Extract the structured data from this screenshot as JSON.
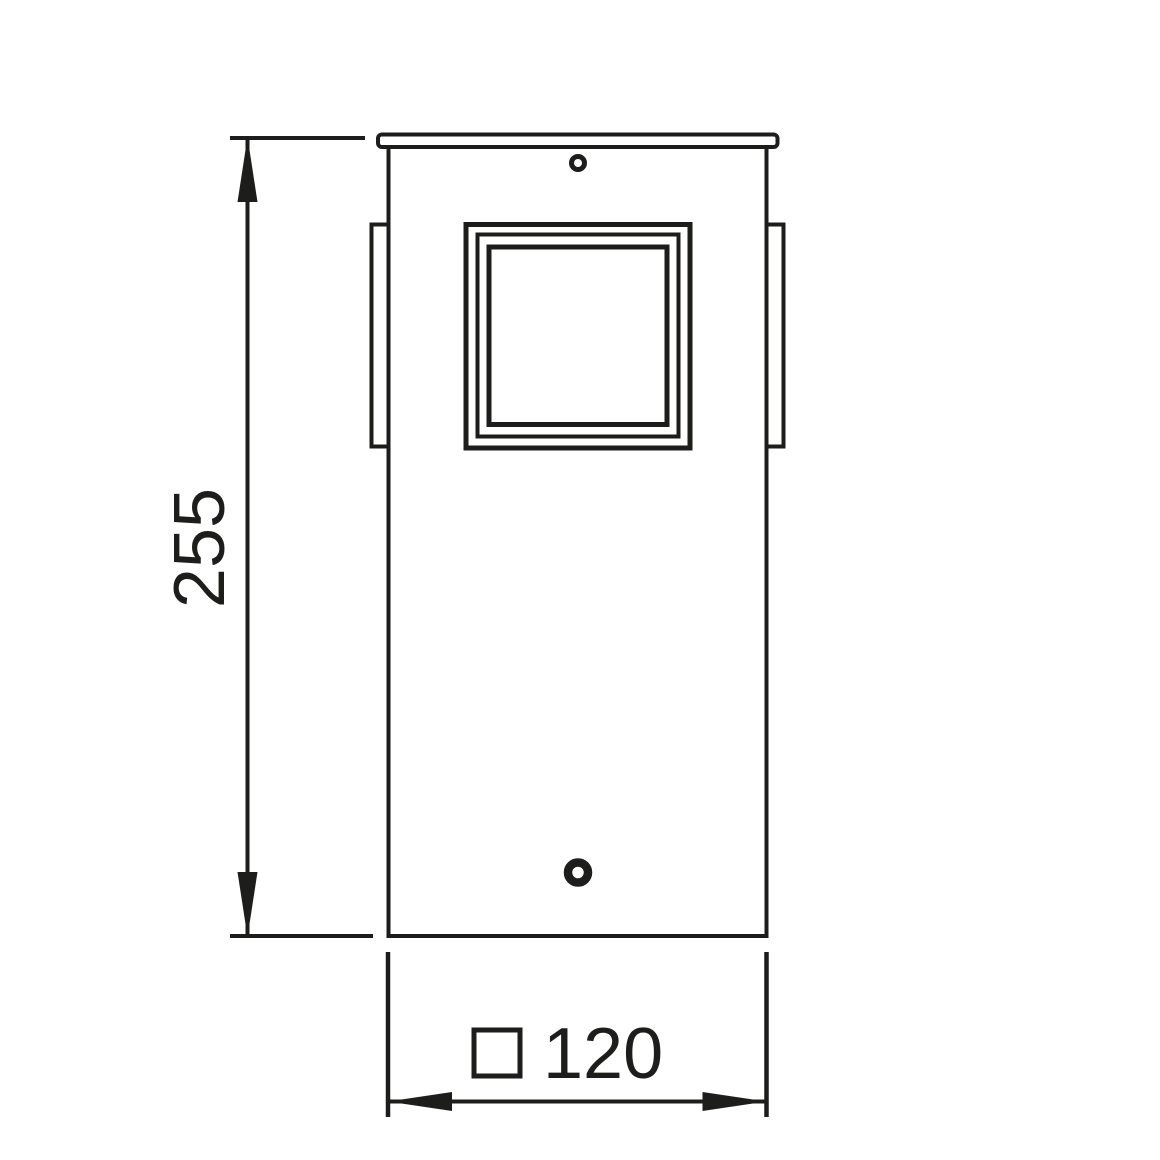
{
  "diagram": {
    "title": "fixture-dimension-drawing",
    "background": "#ffffff",
    "line_color": "#1d1d1b",
    "dimensions": {
      "height": {
        "value": "255",
        "orientation": "vertical"
      },
      "width": {
        "value": "120",
        "symbol": "□",
        "orientation": "horizontal"
      }
    }
  }
}
